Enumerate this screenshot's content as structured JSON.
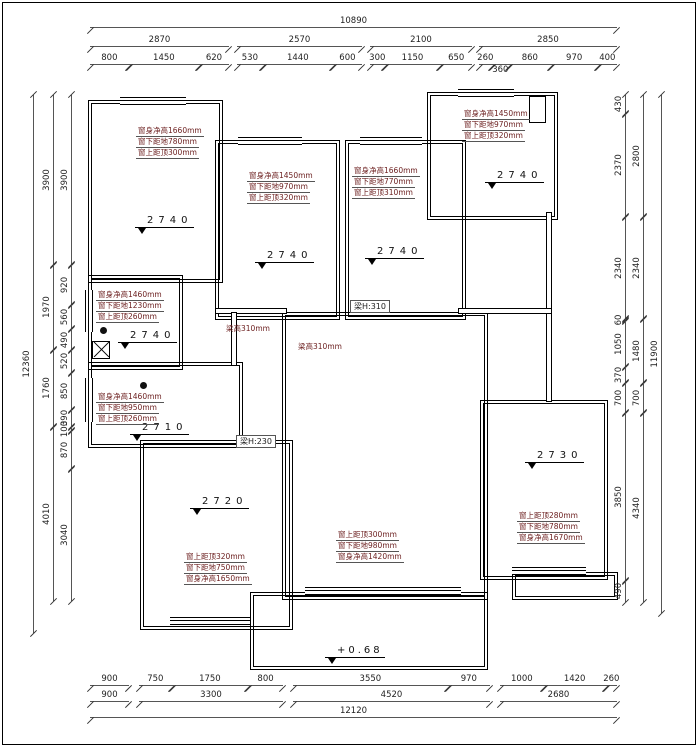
{
  "dims": {
    "top": {
      "total": "10890",
      "row2": [
        "2870",
        "2570",
        "2100",
        "2850"
      ],
      "row3": [
        "800",
        "1450",
        "620",
        "530",
        "1440",
        "600",
        "300",
        "1150",
        "650",
        "260",
        "360",
        "860",
        "970",
        "400"
      ]
    },
    "bottom": {
      "row1": [
        "900",
        "750",
        "1750",
        "800",
        "3550",
        "970",
        "1000",
        "1420",
        "260"
      ],
      "row2": [
        "900",
        "3300",
        "4520",
        "2680"
      ],
      "total": "12120"
    },
    "left": {
      "total": "12360",
      "mid": [
        "3900",
        "1970",
        "1760",
        "4010"
      ],
      "inner": [
        "3900",
        "920",
        "560",
        "490",
        "520",
        "850",
        "390",
        "100",
        "870",
        "3040"
      ]
    },
    "right": {
      "total": "11900",
      "mid": [
        "2800",
        "2340",
        "1480",
        "700",
        "4340"
      ],
      "inner": [
        "430",
        "2370",
        "2340",
        "60",
        "1050",
        "370",
        "700",
        "3850",
        "490"
      ]
    }
  },
  "rooms": {
    "tl": {
      "level": "2740",
      "labels": [
        "窗身净高1660mm",
        "窗下距地780mm",
        "窗上距顶300mm"
      ]
    },
    "tm": {
      "level": "2740",
      "labels": [
        "窗身净高1450mm",
        "窗下距地970mm",
        "窗上距顶320mm"
      ]
    },
    "tmr": {
      "level": "2740",
      "labels": [
        "窗身净高1660mm",
        "窗下距地770mm",
        "窗上距顶310mm"
      ]
    },
    "tr": {
      "level": "2740",
      "labels": [
        "窗身净高1450mm",
        "窗下距地970mm",
        "窗上距顶320mm"
      ]
    },
    "ml": {
      "level": "2740",
      "labels": [
        "窗身净高1460mm",
        "窗下距地1230mm",
        "窗上距顶260mm"
      ]
    },
    "ml2": {
      "level": "2710",
      "labels": [
        "窗身净高1460mm",
        "窗下距地950mm",
        "窗上距顶260mm"
      ]
    },
    "bl": {
      "level": "2720",
      "labels": [
        "窗上距顶320mm",
        "窗下距地750mm",
        "窗身净高1650mm"
      ]
    },
    "center": {
      "level": "+0.68",
      "labels": [
        "窗上距顶300mm",
        "窗下距地980mm",
        "窗身净高1420mm"
      ]
    },
    "right": {
      "level": "2730",
      "labels": [
        "窗上距顶280mm",
        "窗下距地780mm",
        "窗身净高1670mm"
      ]
    }
  },
  "beams": {
    "b1": "梁高310mm",
    "b2": "梁高310mm",
    "b3": "梁H:310",
    "b4": "梁H:230"
  }
}
